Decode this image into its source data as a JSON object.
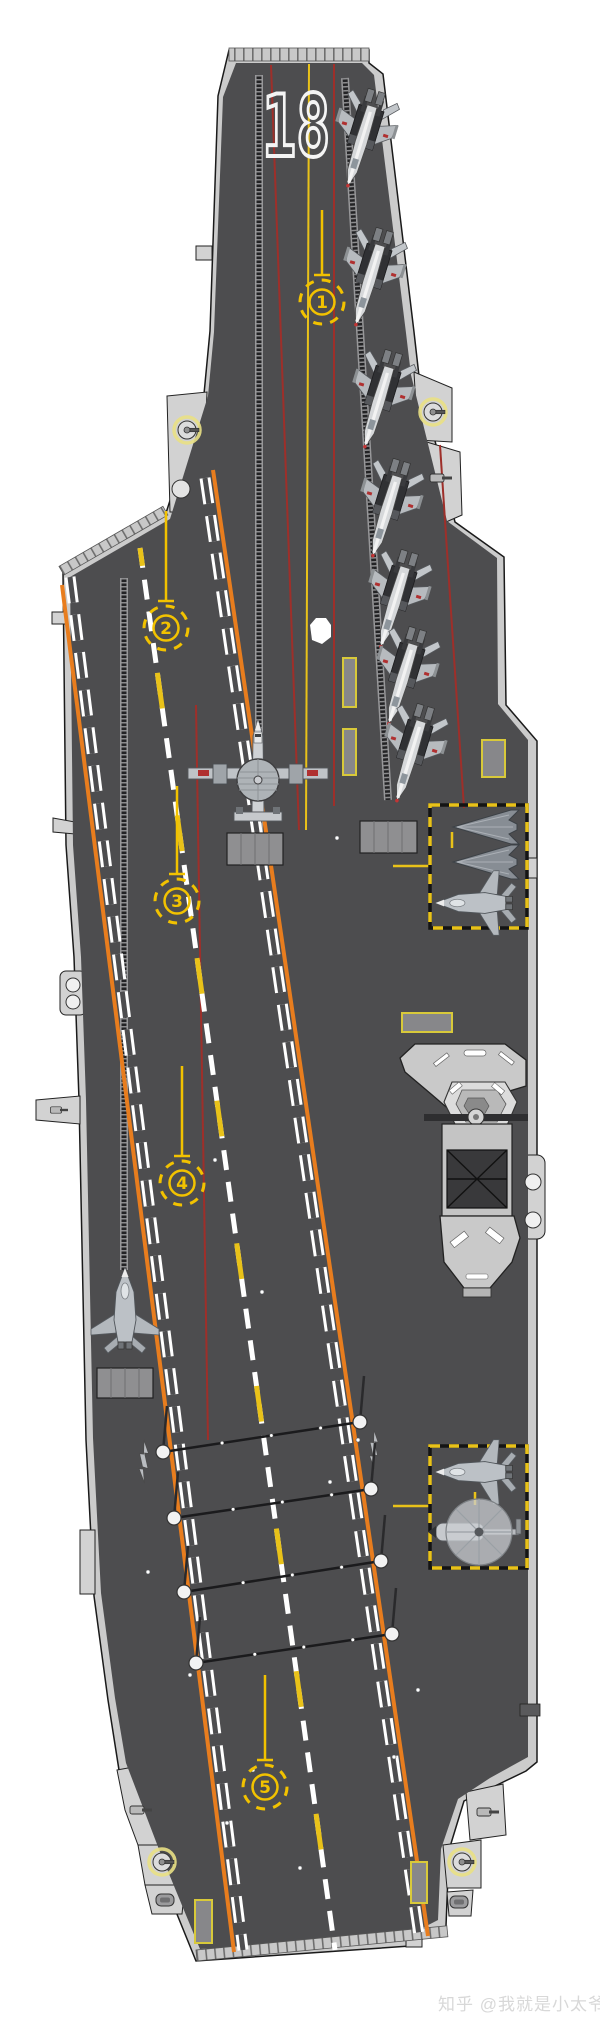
{
  "page": {
    "background": "#ffffff"
  },
  "colors": {
    "deck": "#4d4d4f",
    "hull": "#cbcbcb",
    "orange": "#e87d1e",
    "yellow": "#e9c219",
    "red": "#9e2f2a",
    "anno": "#f2c200"
  },
  "ship": {
    "hull_number": "18",
    "type_note": "aircraft-carrier-deck-plan"
  },
  "watermark": {
    "text": "知乎 @我就是小太爷"
  },
  "annotations": {
    "spots": [
      {
        "label": "1",
        "x": 322,
        "y": 302,
        "stem": 65
      },
      {
        "label": "2",
        "x": 166,
        "y": 628,
        "stem": 90
      },
      {
        "label": "3",
        "x": 177,
        "y": 901,
        "stem": 88
      },
      {
        "label": "4",
        "x": 182,
        "y": 1183,
        "stem": 90
      },
      {
        "label": "5",
        "x": 265,
        "y": 1787,
        "stem": 85
      }
    ]
  },
  "aircraft": [
    {
      "type": "fighter",
      "name": "folded-wing-fighter",
      "x": 364,
      "y": 133,
      "rot": 197
    },
    {
      "type": "fighter",
      "name": "folded-wing-fighter",
      "x": 372,
      "y": 272,
      "rot": 197
    },
    {
      "type": "fighter",
      "name": "folded-wing-fighter",
      "x": 381,
      "y": 394,
      "rot": 197
    },
    {
      "type": "fighter",
      "name": "folded-wing-fighter",
      "x": 389,
      "y": 503,
      "rot": 197
    },
    {
      "type": "fighter",
      "name": "folded-wing-fighter",
      "x": 397,
      "y": 594,
      "rot": 197
    },
    {
      "type": "fighter",
      "name": "folded-wing-fighter",
      "x": 405,
      "y": 671,
      "rot": 197
    },
    {
      "type": "fighter",
      "name": "folded-wing-fighter",
      "x": 413,
      "y": 748,
      "rot": 197
    },
    {
      "type": "aew",
      "name": "aew-radar-plane",
      "x": 258,
      "y": 782,
      "rot": 0
    },
    {
      "type": "uav",
      "name": "stealth-uav",
      "x": 489,
      "y": 827,
      "rot": -90,
      "scale": 1.0
    },
    {
      "type": "uav",
      "name": "stealth-uav",
      "x": 489,
      "y": 862,
      "rot": -90,
      "scale": 1.0
    },
    {
      "type": "stealth",
      "name": "stealth-fighter",
      "x": 483,
      "y": 903,
      "rot": -90,
      "scale": 0.95
    },
    {
      "type": "stealth",
      "name": "stealth-fighter",
      "x": 483,
      "y": 1472,
      "rot": -90,
      "scale": 0.95
    },
    {
      "type": "helo",
      "name": "helicopter",
      "x": 479,
      "y": 1532,
      "rot": 0
    },
    {
      "type": "stealth",
      "name": "stealth-fighter",
      "x": 125,
      "y": 1318,
      "rot": 0
    }
  ],
  "elevators": [
    {
      "x": 430,
      "y": 805,
      "w": 97,
      "h": 123
    },
    {
      "x": 430,
      "y": 1446,
      "w": 97,
      "h": 122
    }
  ],
  "arresting_wires": [
    {
      "x1": 163,
      "y1": 1452,
      "x2": 360,
      "y2": 1422
    },
    {
      "x1": 174,
      "y1": 1518,
      "x2": 371,
      "y2": 1489
    },
    {
      "x1": 184,
      "y1": 1592,
      "x2": 381,
      "y2": 1561
    },
    {
      "x1": 196,
      "y1": 1663,
      "x2": 392,
      "y2": 1634
    }
  ]
}
